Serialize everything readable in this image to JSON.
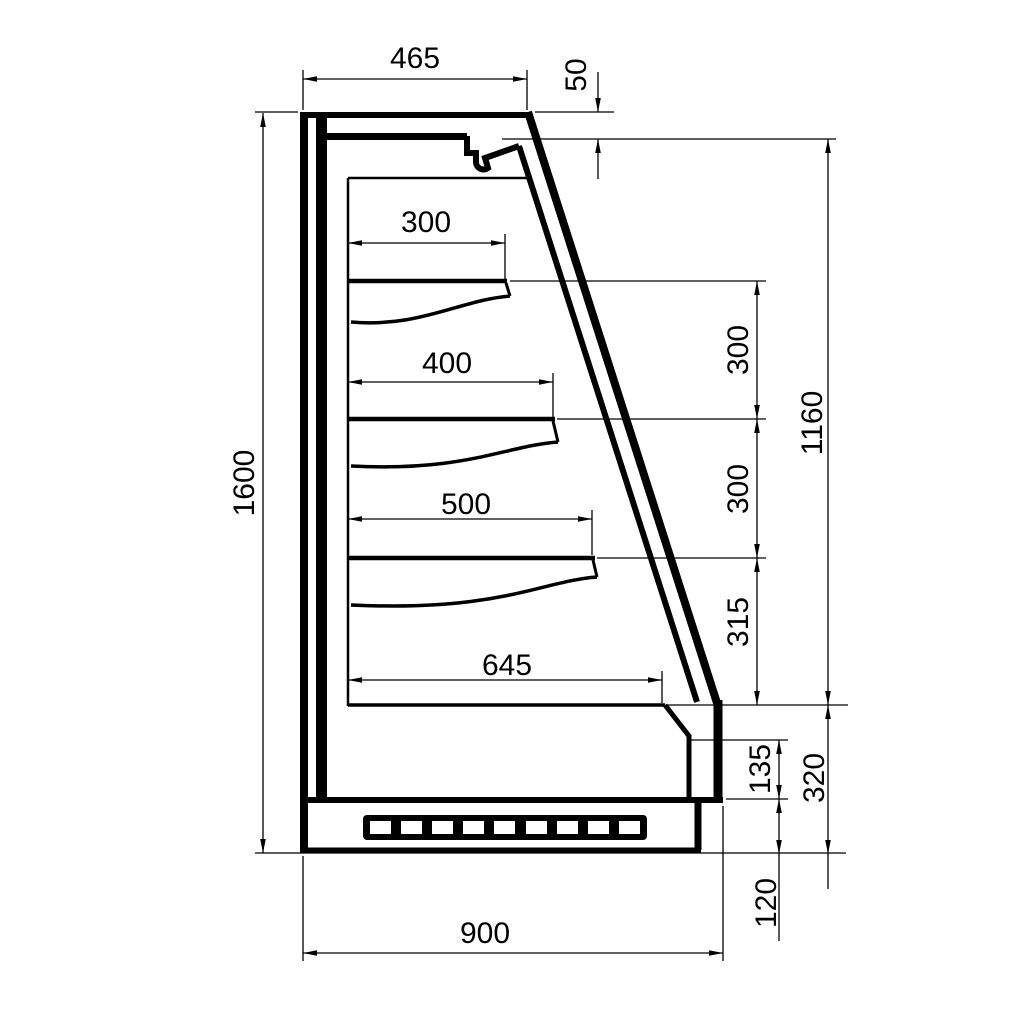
{
  "drawing": {
    "background_color": "#ffffff",
    "line_color": "#000000",
    "dimensions": {
      "top_width": {
        "label": "465",
        "orientation": "horizontal"
      },
      "top_drop": {
        "label": "50",
        "orientation": "vertical"
      },
      "shelf1_depth": {
        "label": "300",
        "orientation": "horizontal"
      },
      "shelf2_depth": {
        "label": "400",
        "orientation": "horizontal"
      },
      "shelf3_depth": {
        "label": "500",
        "orientation": "horizontal"
      },
      "bottom_shelf_depth": {
        "label": "645",
        "orientation": "horizontal"
      },
      "total_height": {
        "label": "1600",
        "orientation": "vertical"
      },
      "shelf_gap_1": {
        "label": "300",
        "orientation": "vertical"
      },
      "shelf_gap_2": {
        "label": "300",
        "orientation": "vertical"
      },
      "shelf_gap_3": {
        "label": "315",
        "orientation": "vertical"
      },
      "opening_height": {
        "label": "1160",
        "orientation": "vertical"
      },
      "bumper_height": {
        "label": "135",
        "orientation": "vertical"
      },
      "lower_front_height": {
        "label": "320",
        "orientation": "vertical"
      },
      "plinth_height": {
        "label": "120",
        "orientation": "vertical"
      },
      "total_depth": {
        "label": "900",
        "orientation": "horizontal"
      }
    }
  }
}
